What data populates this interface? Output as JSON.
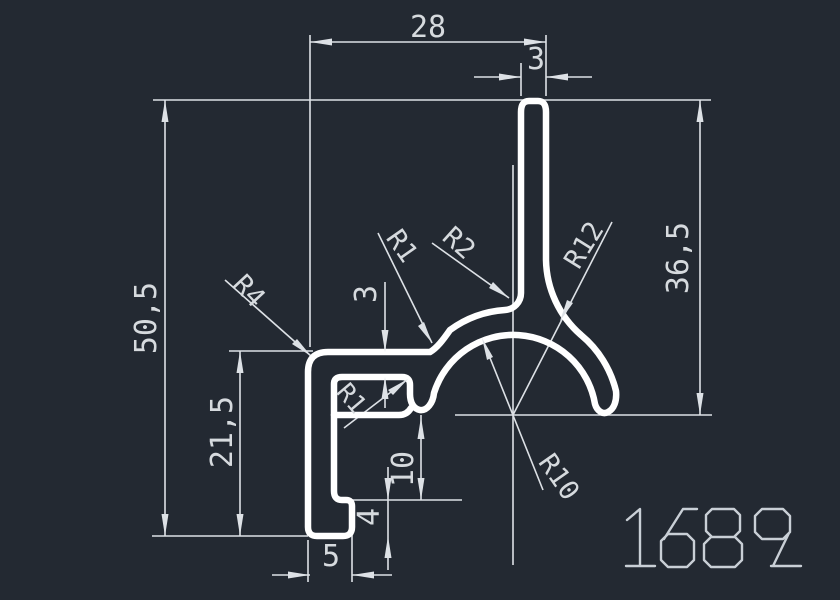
{
  "title": "Extrusion profile drawing",
  "part_number": "1689",
  "colors": {
    "background": "#232932",
    "profile": "#ffffff",
    "dim": "#dde1e6",
    "text": "#d6dade",
    "partnum": "#c9cfd6"
  },
  "dimensions": {
    "overall_width": "28",
    "stem_thickness": "3",
    "overall_height": "50,5",
    "stem_height": "36,5",
    "left_height": "21,5",
    "arm_thickness": "3",
    "slot_height": "10",
    "foot_height": "4",
    "foot_width": "5"
  },
  "radii": {
    "corner": "R4",
    "arm_fillet": "R1",
    "stem_left_fillet": "R2",
    "stem_right_fillet": "R12",
    "dome_inner": "R10",
    "box_fillet": "R1"
  }
}
